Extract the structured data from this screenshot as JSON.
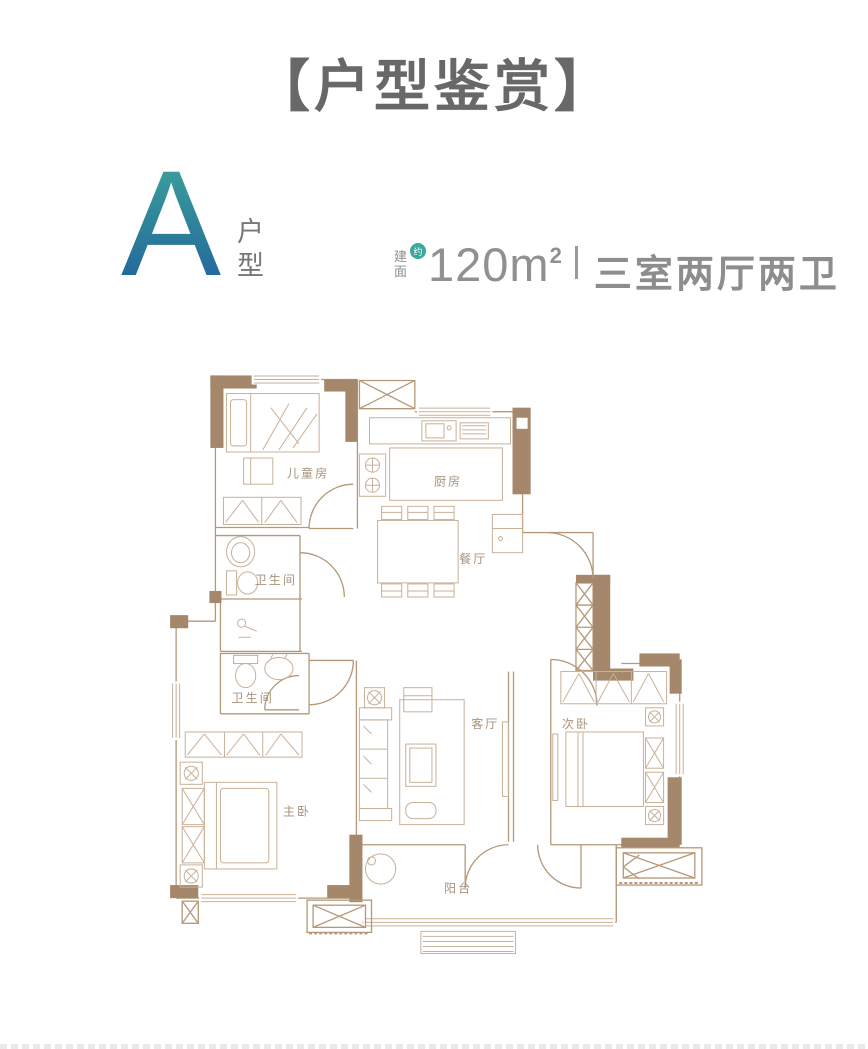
{
  "header": {
    "title": "【户型鉴赏】"
  },
  "unit": {
    "letter": "A",
    "type_char_1": "户",
    "type_char_2": "型"
  },
  "specs": {
    "area_label_top": "建",
    "area_label_bottom": "面",
    "approx_badge": "约",
    "area_value": "120m",
    "area_sup": "2",
    "layout_text": "三室两厅两卫"
  },
  "colors": {
    "wall": "#a5886b",
    "thin_line": "#b59878",
    "furniture": "#c9b199",
    "room_label": "#a8937d",
    "title_text": "#686868",
    "spec_text": "#8d8d8d",
    "badge": "#3aa89b",
    "letter_gradient_top": "#3fa79a",
    "letter_gradient_bottom": "#1f5f9c"
  },
  "floorplan": {
    "rooms": [
      {
        "name": "儿童房",
        "x": 149,
        "y": 122
      },
      {
        "name": "厨房",
        "x": 288,
        "y": 130
      },
      {
        "name": "餐厅",
        "x": 313,
        "y": 207
      },
      {
        "name": "卫生间",
        "x": 117,
        "y": 228
      },
      {
        "name": "卫生间",
        "x": 94,
        "y": 345
      },
      {
        "name": "客厅",
        "x": 325,
        "y": 371
      },
      {
        "name": "次卧",
        "x": 415,
        "y": 371
      },
      {
        "name": "主卧",
        "x": 138,
        "y": 458
      },
      {
        "name": "阳台",
        "x": 298,
        "y": 534
      }
    ]
  }
}
